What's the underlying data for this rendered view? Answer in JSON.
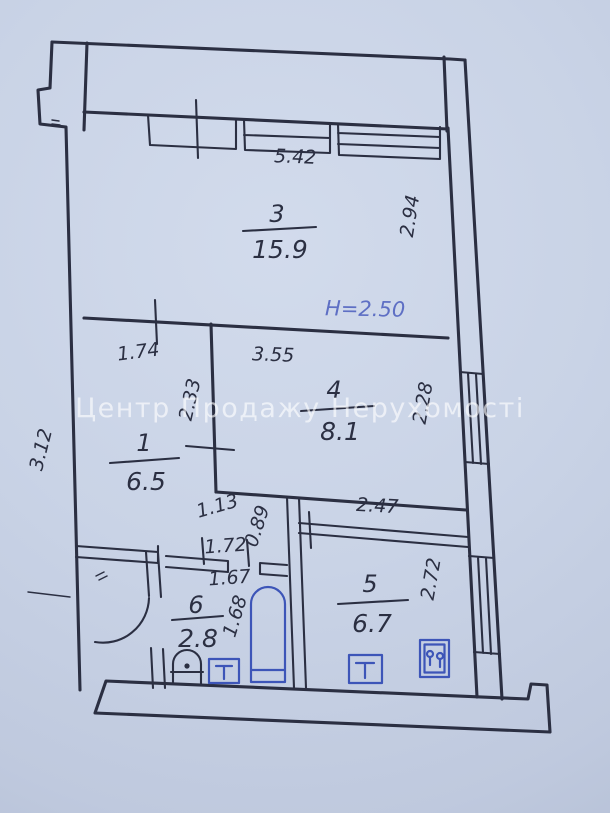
{
  "plan": {
    "watermark": "Центр Продажу Нерухомості",
    "height_note": "H=2.50",
    "rooms": {
      "r3": {
        "number": "3",
        "area": "15.9"
      },
      "r4": {
        "number": "4",
        "area": "8.1"
      },
      "r1": {
        "number": "1",
        "area": "6.5"
      },
      "r5": {
        "number": "5",
        "area": "6.7"
      },
      "r6": {
        "number": "6",
        "area": "2.8"
      }
    },
    "dims": {
      "d542": "5.42",
      "d294": "2.94",
      "d174": "1.74",
      "d355": "3.55",
      "d233": "2.33",
      "d228": "2.28",
      "d312": "3.12",
      "d113": "1.13",
      "d089": "0.89",
      "d247": "2.47",
      "d172": "1.72",
      "d167": "1.67",
      "d168": "1.68",
      "d272": "2.72"
    },
    "colors": {
      "ink": "#2b2f42",
      "fixture_blue": "#3d55b8",
      "note_blue": "#5e6fc4",
      "paper": "#c9d3e6",
      "watermark": "rgba(255,255,255,0.62)"
    },
    "fixtures": [
      "bathtub",
      "toilet",
      "bathroom-sink",
      "kitchen-sink",
      "stove"
    ]
  }
}
